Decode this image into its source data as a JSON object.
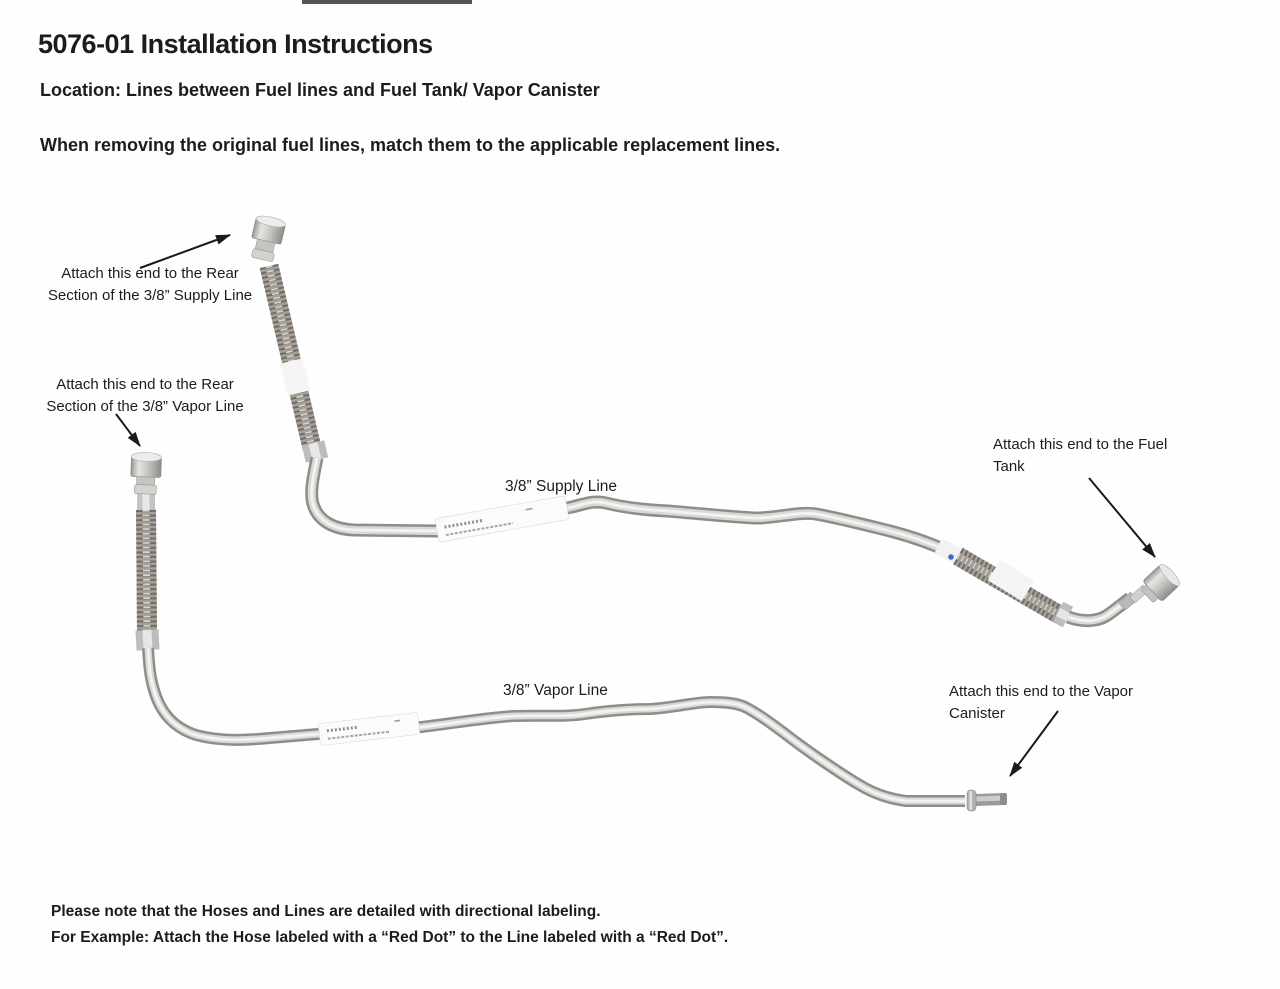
{
  "header": {
    "title": "5076-01 Installation Instructions",
    "location": "Location: Lines between Fuel lines and Fuel Tank/ Vapor Canister",
    "instruction": "When removing the original fuel lines, match them to the applicable replacement lines."
  },
  "diagram": {
    "annotations": {
      "supply_rear": {
        "line1": "Attach this end to the Rear",
        "line2": "Section of the 3/8” Supply Line"
      },
      "vapor_rear": {
        "line1": "Attach this end to the Rear",
        "line2": "Section of the 3/8” Vapor Line"
      },
      "fuel_tank": {
        "line1": "Attach this end to the Fuel",
        "line2": "Tank"
      },
      "vapor_canister": {
        "line1": "Attach this end to the Vapor",
        "line2": "Canister"
      }
    },
    "line_labels": {
      "supply": "3/8” Supply Line",
      "vapor": "3/8” Vapor Line"
    }
  },
  "footer": {
    "note1": "Please note that the Hoses and Lines are detailed with directional labeling.",
    "note2": "For Example: Attach the Hose labeled with a “Red Dot” to the Line labeled with a “Red Dot”."
  },
  "colors": {
    "text": "#1c1c1c",
    "blue_dot": "#3f6cc4",
    "tube_base": "#8f8d8a",
    "tube_highlight": "#f3f2f0",
    "braid_base": "#a59f98"
  }
}
